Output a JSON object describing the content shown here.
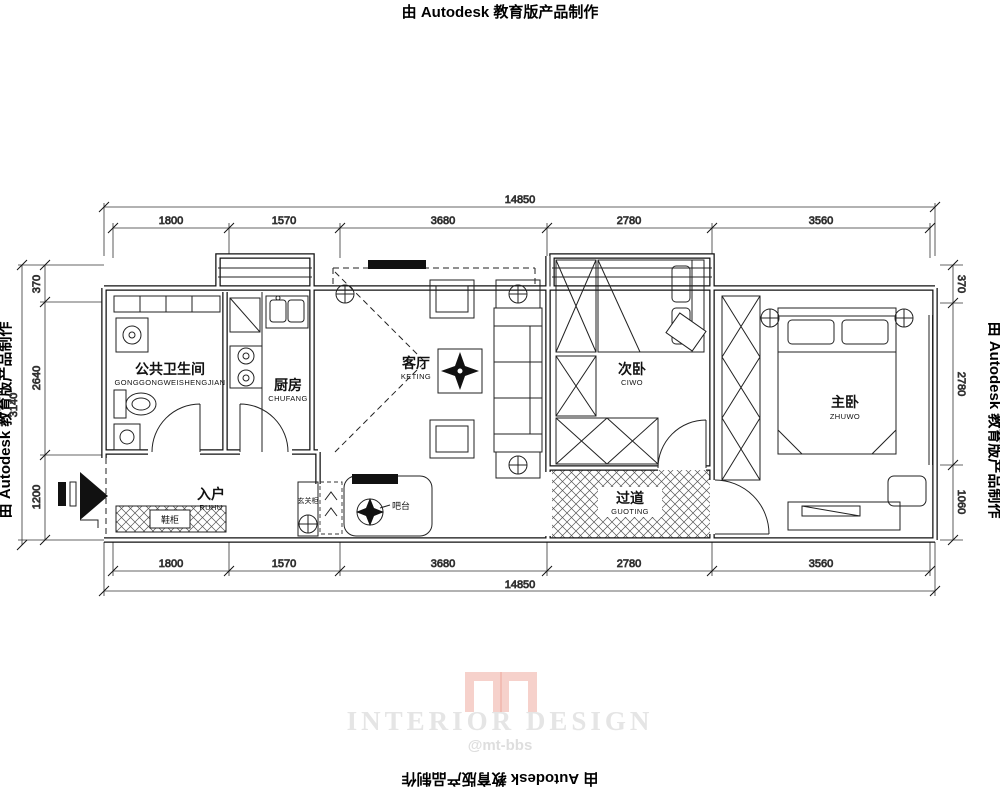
{
  "watermarks": {
    "top": "由 Autodesk 教育版产品制作",
    "bottom": "由 Autodesk 教育版产品制作",
    "left": "由 Autodesk 教育版产品制作",
    "right": "由 Autodesk 教育版产品制作"
  },
  "logo": {
    "title": "INTERIOR DESIGN",
    "subtitle": "@mt-bbs",
    "color": "#efaca1",
    "text_color": "#e5e5e5"
  },
  "dimensions": {
    "overall_width": "14850",
    "top_segments": [
      "1800",
      "1570",
      "3680",
      "2780",
      "3560"
    ],
    "bottom_segments": [
      "1800",
      "1570",
      "3680",
      "2780",
      "3560"
    ],
    "overall_left": "3140",
    "left_segments": [
      "370",
      "2640",
      "1200"
    ],
    "right_segments": [
      "370",
      "2780",
      "1060"
    ]
  },
  "rooms": {
    "bathroom": {
      "name": "公共卫生间",
      "pinyin": "GONGGONGWEISHENGJIAN"
    },
    "kitchen": {
      "name": "厨房",
      "pinyin": "CHUFANG"
    },
    "living": {
      "name": "客厅",
      "pinyin": "KETING"
    },
    "bedroom2": {
      "name": "次卧",
      "pinyin": "CIWO"
    },
    "bedroom1": {
      "name": "主卧",
      "pinyin": "ZHUWO"
    },
    "entry": {
      "name": "入户",
      "pinyin": "RUHU"
    },
    "hallway": {
      "name": "过道",
      "pinyin": "GUOTING"
    }
  },
  "annotations": {
    "shoe_cabinet": "鞋柜",
    "entry_cabinet": "玄关柜",
    "bar": "吧台"
  },
  "colors": {
    "line": "#1a1a1a"
  }
}
